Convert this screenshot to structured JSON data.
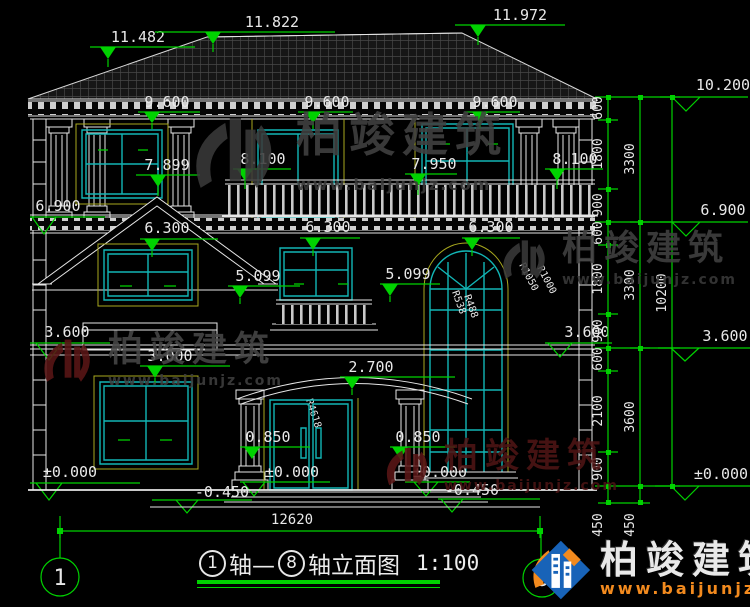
{
  "colors": {
    "dim_green": "#00d200",
    "window_cyan": "#12b6b6",
    "trim_yellow": "#a8a81e",
    "line_white": "#e6e6e6",
    "watermark_gray": "#414141",
    "watermark_red": "#4f1515",
    "logo_blue": "#1863b8",
    "logo_orange": "#f28a1e"
  },
  "roof_levels": {
    "left_lower": "11.482",
    "left_ridge": "11.822",
    "right_ridge": "11.972"
  },
  "eave_levels": {
    "left": "9.600",
    "center": "9.600",
    "right": "9.600"
  },
  "floor2_levels": {
    "window_sill_left": "7.899",
    "window_sill_center": "7.950",
    "balcony_left": "8.100",
    "balcony_right": "8.100"
  },
  "floor3_levels": {
    "window_head_left": "6.300",
    "window_head_center": "6.300",
    "arch_head": "6.300",
    "sill_left": "5.099",
    "sill_center": "5.099"
  },
  "floor1_levels": {
    "band_left": "3.600",
    "band_right": "3.600",
    "window_head_left": "3.000",
    "entry_arch": "2.700",
    "sill_left": "0.850",
    "sill_right": "0.850"
  },
  "ground_levels": {
    "zero_left": "±0.000",
    "zero_center": "±0.000",
    "zero_right": "±0.000",
    "minus_left": "-0.450",
    "minus_right": "-0.450"
  },
  "right_axis_levels": {
    "top": "10.200",
    "mid": "6.900",
    "low": "3.600",
    "zero": "±0.000"
  },
  "left_axis_levels": {
    "mid": "6.900"
  },
  "radii": {
    "arc_outer": "R1050",
    "arc_inner": "R1000",
    "arc_small_outer": "R538",
    "arc_small_inner": "R488",
    "entry_arch": "R4618"
  },
  "dims": {
    "col1": [
      "600",
      "1800",
      "900",
      "600",
      "1800",
      "900",
      "600",
      "2100",
      "900",
      "450"
    ],
    "col2": [
      "3300",
      "3300",
      "3600",
      "450"
    ],
    "col3": [
      "10200"
    ],
    "total_width": "12620"
  },
  "axes": {
    "start": "1",
    "end": "8"
  },
  "title": {
    "axis_start": "1",
    "joiner": "轴—",
    "axis_end": "8",
    "suffix": "轴立面图",
    "scale": "1:100"
  },
  "watermark": {
    "brand": "柏竣建筑",
    "url": "www.baijunjz.com"
  },
  "logo": {
    "brand": "柏竣建筑",
    "url": "www.baijunjz.com"
  }
}
